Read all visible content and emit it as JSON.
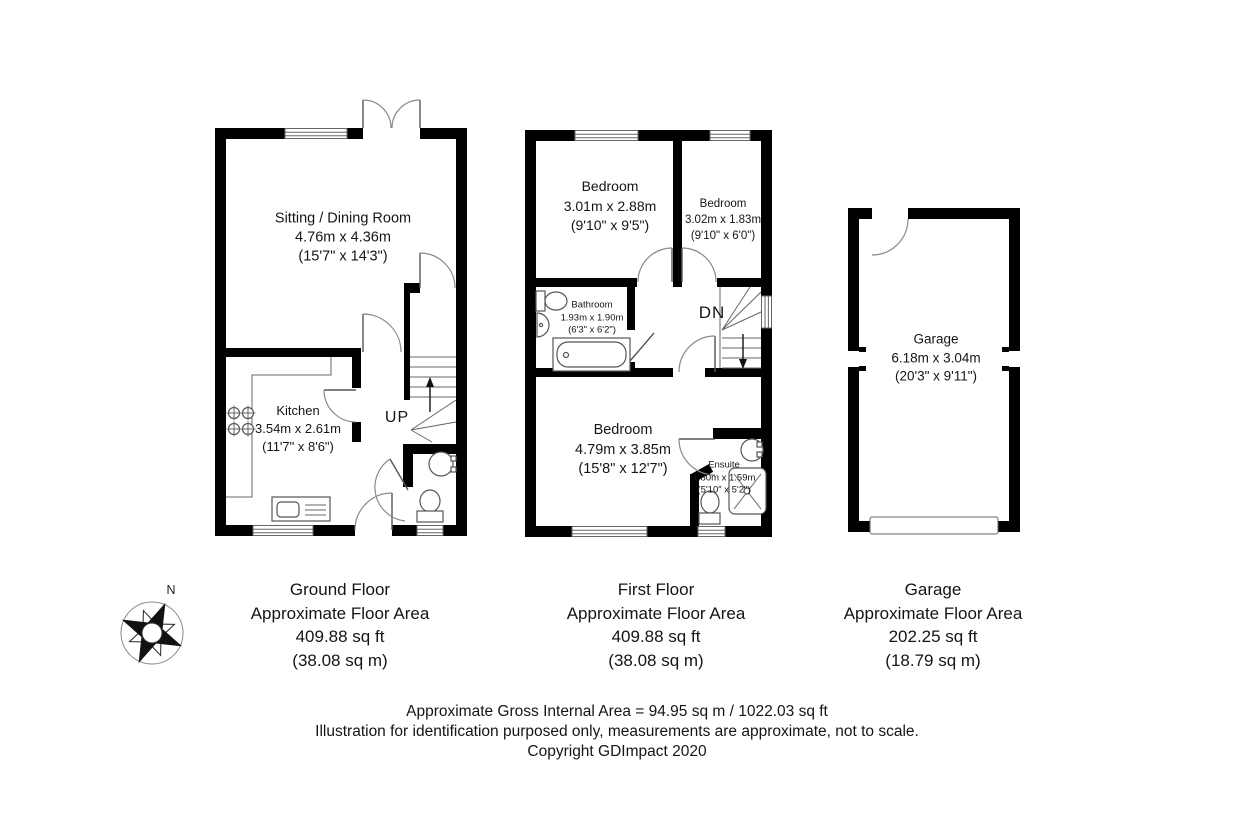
{
  "meta": {
    "background": "#ffffff",
    "wall_color": "#000000",
    "fixture_line_color": "#555555",
    "text_color": "#151515"
  },
  "compass": {
    "north_label": "N"
  },
  "ground_floor": {
    "sitting_room": {
      "name": "Sitting / Dining Room",
      "size_metric": "4.76m x 4.36m",
      "size_imperial": "(15'7\" x 14'3\")"
    },
    "kitchen": {
      "name": "Kitchen",
      "size_metric": "3.54m x 2.61m",
      "size_imperial": "(11'7\" x 8'6\")"
    },
    "stairs_label": "UP"
  },
  "first_floor": {
    "bedroom1": {
      "name": "Bedroom",
      "size_metric": "3.01m x 2.88m",
      "size_imperial": "(9'10\" x 9'5\")"
    },
    "bedroom2": {
      "name": "Bedroom",
      "size_metric": "3.02m x 1.83m",
      "size_imperial": "(9'10\" x 6'0\")"
    },
    "bathroom": {
      "name": "Bathroom",
      "size_metric": "1.93m x 1.90m",
      "size_imperial": "(6'3\" x 6'2\")"
    },
    "bedroom3": {
      "name": "Bedroom",
      "size_metric": "4.79m x 3.85m",
      "size_imperial": "(15'8\" x 12'7\")"
    },
    "ensuite": {
      "name": "Ensuite",
      "size_metric": "1.80m x 1.59m",
      "size_imperial": "(5'10\" x 5'2\")"
    },
    "stairs_label": "DN"
  },
  "garage": {
    "room": {
      "name": "Garage",
      "size_metric": "6.18m x 3.04m",
      "size_imperial": "(20'3\" x 9'11\")"
    }
  },
  "captions": {
    "ground_floor": {
      "title": "Ground Floor",
      "line2": "Approximate Floor Area",
      "line3": "409.88 sq ft",
      "line4": "(38.08 sq m)"
    },
    "first_floor": {
      "title": "First Floor",
      "line2": "Approximate Floor Area",
      "line3": "409.88 sq ft",
      "line4": "(38.08 sq m)"
    },
    "garage": {
      "title": "Garage",
      "line2": "Approximate Floor Area",
      "line3": "202.25 sq ft",
      "line4": "(18.79 sq m)"
    }
  },
  "footer": {
    "line1": "Approximate Gross Internal Area = 94.95 sq m / 1022.03 sq ft",
    "line2": "Illustration for identification purposed only, measurements are approximate, not to scale.",
    "line3": "Copyright GDImpact 2020"
  }
}
